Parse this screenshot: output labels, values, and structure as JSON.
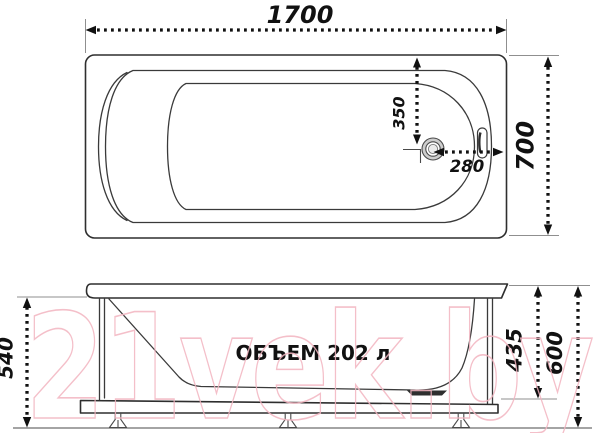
{
  "top_view": {
    "length": "1700",
    "width": "700",
    "drain_offset_top": "350",
    "drain_offset_right": "280"
  },
  "side_view": {
    "body_height": "540",
    "inner_depth": "435",
    "total_height": "600",
    "volume": "ОБЪЕМ 202 л"
  },
  "watermark": {
    "text": "21vek.by",
    "color": "#f2b4c0"
  },
  "colors": {
    "line": "#3a3a3a",
    "dimension": "#111111",
    "extension": "#8f8f8f",
    "drain_ring": "#cdcdcd"
  }
}
